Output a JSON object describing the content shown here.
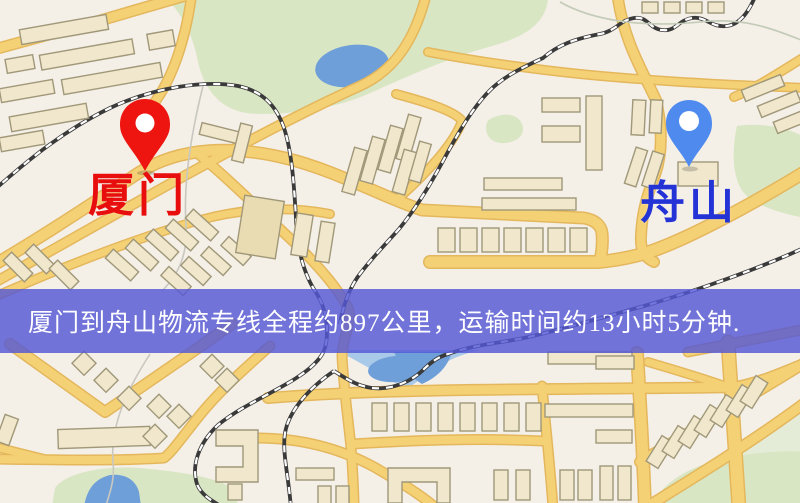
{
  "banner": {
    "text": "厦门到舟山物流专线全程约897公里，运输时间约13小时5分钟.",
    "bg_color": "rgba(84,88,214,0.82)",
    "text_color": "#ffffff"
  },
  "markers": {
    "origin": {
      "label": "厦门",
      "pin_color": "#ee1410",
      "label_color": "#e80e0e"
    },
    "destination": {
      "label": "舟山",
      "pin_color": "#4f8bef",
      "label_color": "#2433d6"
    }
  },
  "map": {
    "colors": {
      "background": "#f4efe7",
      "road": "#f5d176",
      "road_edge": "#e4b75c",
      "building_fill": "#f0e7cc",
      "building_stroke": "#a09879",
      "building_dark": "#e9dcb2",
      "park": "#d9e6c3",
      "park_light": "#e4ecd8",
      "water": "#a9c9e8",
      "water_deep": "#6f9fd8",
      "railway": "#3a3a3a",
      "rail_dash": "#ffffff",
      "contour": "#c8c8c0"
    }
  }
}
